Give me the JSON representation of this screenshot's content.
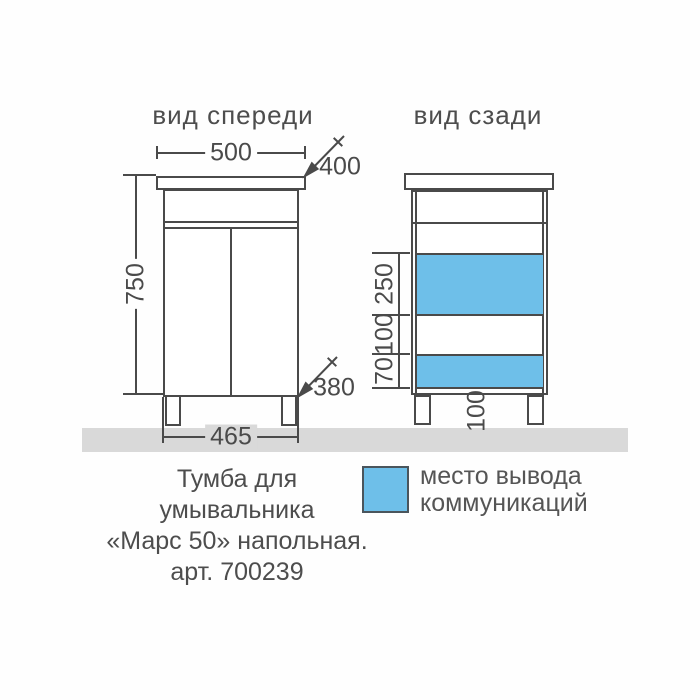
{
  "drawing": {
    "front_view": {
      "title": "вид спереди",
      "dims": {
        "top_width": "500",
        "top_depth": "400",
        "height": "750",
        "bottom_depth": "380",
        "bottom_width": "465"
      }
    },
    "back_view": {
      "title": "вид сзади",
      "dims": {
        "zone_top": "250",
        "zone_middle": "100",
        "zone_bottom": "70",
        "leg_height": "100"
      }
    },
    "legend": {
      "line1": "место вывода",
      "line2": "коммуникаций",
      "swatch_color": "#6ebfe9"
    },
    "caption": {
      "line1": "Тумба для",
      "line2": "умывальника",
      "line3": "«Марс 50» напольная.",
      "line4": "арт. 700239"
    },
    "colors": {
      "line": "#4a4a4a",
      "accent_blue": "#6ebfe9",
      "floor_gray": "#d9d9d9"
    }
  }
}
